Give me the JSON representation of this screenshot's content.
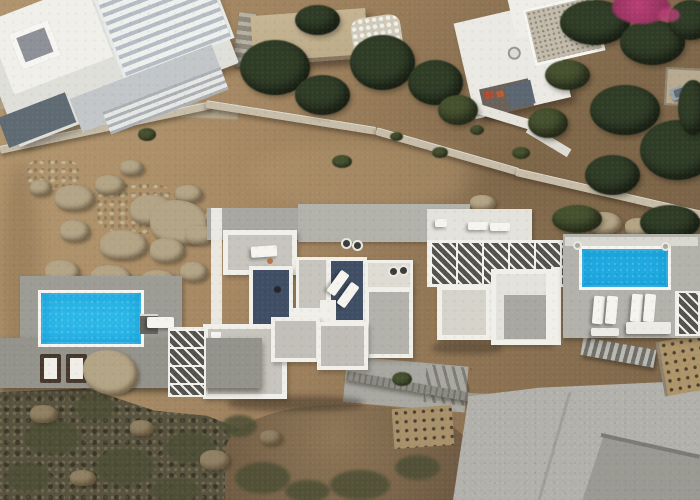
{
  "scene": {
    "type": "aerial-drone-photo",
    "description": "Top-down aerial view of a white Cycladic villa complex on a rocky brown hillside: central flat-roofed villa cluster with two dark slate roof terraces and sun loungers, a cyan swimming pool with deck on the left, a second cyan pool with four loungers on the right, white lattice pergolas, neighbouring white buildings at top-left and top-right, dense green trees and a magenta bougainvillea top-right, stone walls, stairways, a large concrete pad bottom-right and dark scrubby rocks bottom-left."
  },
  "features": [
    "left-swimming-pool",
    "right-swimming-pool",
    "main-villa-roofs",
    "slate-roof-terraces",
    "herringbone-pergola",
    "lattice-pergolas",
    "sun-loungers",
    "stone-walls",
    "stairways",
    "boulder-field",
    "trees",
    "bougainvillea",
    "concrete-pad",
    "planted-beds",
    "parked-car"
  ],
  "palette": {
    "dirt_base": "#9c7f5c",
    "dirt_light": "#b0946d",
    "dirt_dark": "#7a6347",
    "scrub_dark": "#57523d",
    "olive": "#4c4e34",
    "tree_dark": "#2f3c26",
    "tree_mid": "#46512f",
    "rock": "#b4a486",
    "stone_wall": "#c6bca8",
    "path_stone": "#b3a892",
    "white_wall": "#f0efe9",
    "white_bright": "#f6f5f1",
    "white_deck": "#e3e2db",
    "band_light": "#d8d7d0",
    "concrete": "#b2b1aa",
    "concrete_mid": "#a8a7a0",
    "concrete_dark": "#979690",
    "wall_dark": "#8d8c84",
    "deck_gray": "#9c9b94",
    "deck_dark": "#93928b",
    "roof_gray": "#c6c4bc",
    "roof_cream": "#dedbd2",
    "slate_roof": "#3f4e64",
    "pool_left": "#2ab6e7",
    "pool_right": "#1fa9e0",
    "pool_deep": "#0e98d2",
    "lounger_white": "#f5f4ee",
    "towel_brown": "#46382c",
    "cabinet": "#63625c",
    "pergola_shadow": "#53524c",
    "tan_roof": "#c6b493",
    "gravel_roof": "#c2bbab",
    "bougainvillea": "#b93f74",
    "car_gray": "#98a0a7",
    "pad_concrete": "#b1b0aa",
    "ramp_gray": "#9a9992",
    "bed_tan": "#ad9469"
  }
}
